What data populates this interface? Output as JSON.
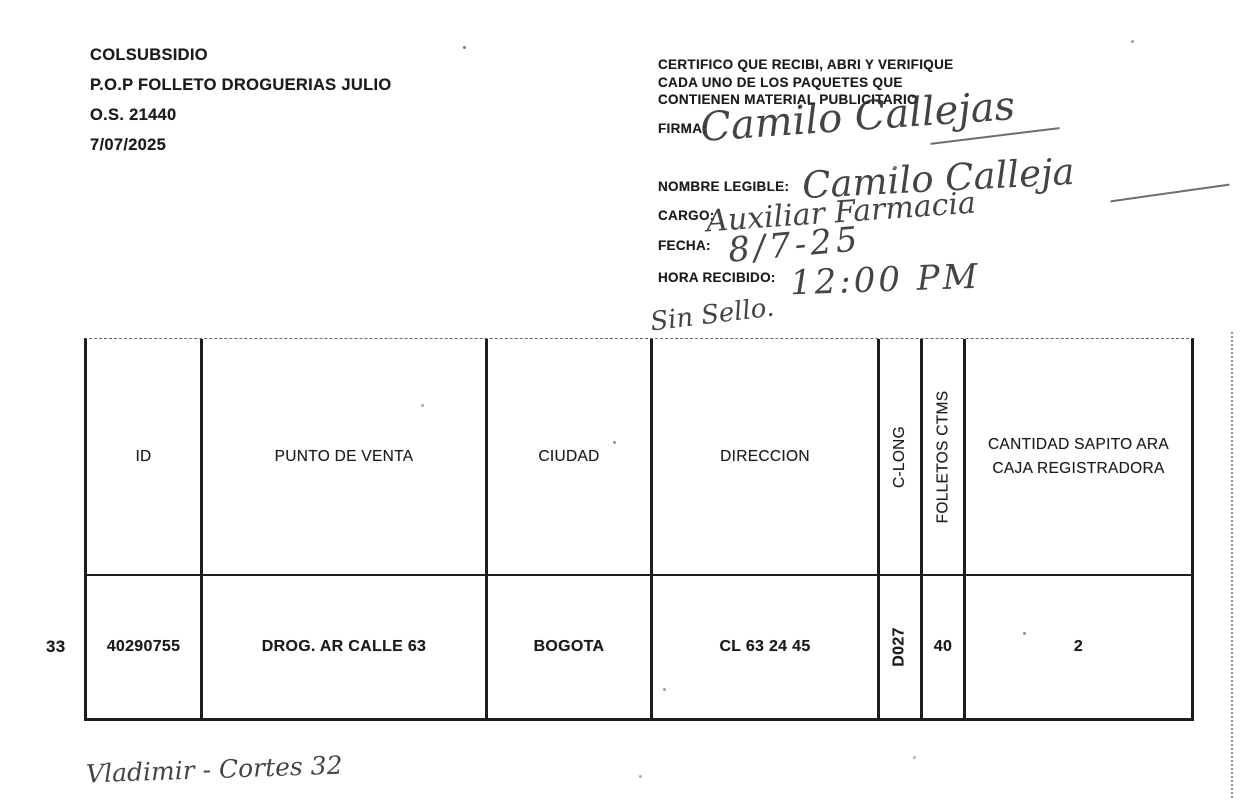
{
  "page": {
    "background_color": "#ffffff",
    "ink_color": "#1b1b1b"
  },
  "doc_info": {
    "company": "COLSUBSIDIO",
    "project": "P.O.P FOLLETO DROGUERIAS JULIO",
    "order_number": "O.S. 21440",
    "date": "7/07/2025"
  },
  "certificate": {
    "statement_lines": [
      "CERTIFICO QUE RECIBI, ABRI Y VERIFIQUE",
      "CADA  UNO DE LOS PAQUETES QUE",
      "CONTIENEN MATERIAL PUBLICITARIO"
    ],
    "fields": [
      {
        "label": "FIRMA:",
        "value": "Camilo Callejas"
      },
      {
        "label": "NOMBRE LEGIBLE:",
        "value": "Camilo Calleja"
      },
      {
        "label": "CARGO:",
        "value": "Auxiliar Farmacia"
      },
      {
        "label": "FECHA:",
        "value": "8/7-25"
      },
      {
        "label": "HORA RECIBIDO:",
        "value": "12:00 PM"
      }
    ],
    "stamp_note": "Sin Sello."
  },
  "table": {
    "row_number": "33",
    "headers": {
      "id": "ID",
      "punto_de_venta": "PUNTO DE VENTA",
      "ciudad": "CIUDAD",
      "direccion": "DIRECCION",
      "c_long": "C-LONG",
      "folletos_ctms": "FOLLETOS CTMS",
      "cantidad": "CANTIDAD SAPITO ARA CAJA REGISTRADORA"
    },
    "rows": [
      {
        "id": "40290755",
        "punto_de_venta": "DROG. AR CALLE 63",
        "ciudad": "BOGOTA",
        "direccion": "CL 63 24 45",
        "c_long": "D027",
        "folletos_ctms": "40",
        "cantidad": "2"
      }
    ]
  },
  "footer": {
    "handwritten_note": "Vladimir - Cortes 32"
  }
}
